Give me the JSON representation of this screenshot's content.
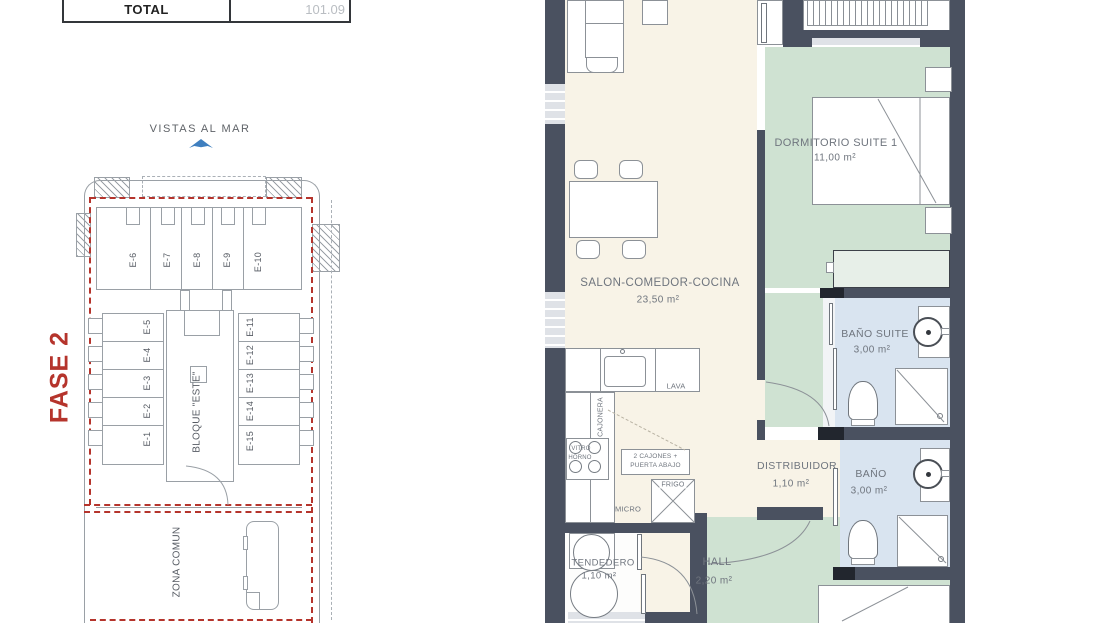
{
  "palette": {
    "wall": "#4a5160",
    "room_cream": "#f8f3e7",
    "room_green": "#cfe2d2",
    "room_blue": "#d9e4f0",
    "accent_red": "#b5342c",
    "sea_icon_blue": "#3f7fbf",
    "line_gray": "#9aa0a6",
    "text_gray": "#6f757e"
  },
  "summary_table": {
    "total_label": "TOTAL",
    "total_value": "101.09"
  },
  "site_plan": {
    "sea_label": "VISTAS AL MAR",
    "phase_label": "FASE 2",
    "block_label": "BLOQUE \"ESTE\"",
    "common_area_label": "ZONA COMUN",
    "units_top": [
      "E-6",
      "E-7",
      "E-8",
      "E-9",
      "E-10"
    ],
    "units_left": [
      "E-5",
      "E-4",
      "E-3",
      "E-2",
      "E-1"
    ],
    "units_right": [
      "E-11",
      "E-12",
      "E-13",
      "E-14",
      "E-15"
    ]
  },
  "floor_plan": {
    "rooms": [
      {
        "name": "SALON-COMEDOR-COCINA",
        "area": "23,50 m²"
      },
      {
        "name": "DORMITORIO SUITE 1",
        "area": "11,00 m²"
      },
      {
        "name": "BAÑO SUITE",
        "area": "3,00 m²"
      },
      {
        "name": "BAÑO",
        "area": "3,00 m²"
      },
      {
        "name": "DISTRIBUIDOR",
        "area": "1,10 m²"
      },
      {
        "name": "HALL",
        "area": "2,20 m²"
      },
      {
        "name": "TENDEDERO",
        "area": "1,10 m²"
      }
    ],
    "kitchen": {
      "lava": "LAVA",
      "cajonera": "CAJONERA",
      "vitro": "VITRO",
      "horno": "HORNO",
      "drawers_note": "2 CAJONES + PUERTA ABAJO",
      "fridge": "FRIGO",
      "micro": "MICRO"
    }
  }
}
